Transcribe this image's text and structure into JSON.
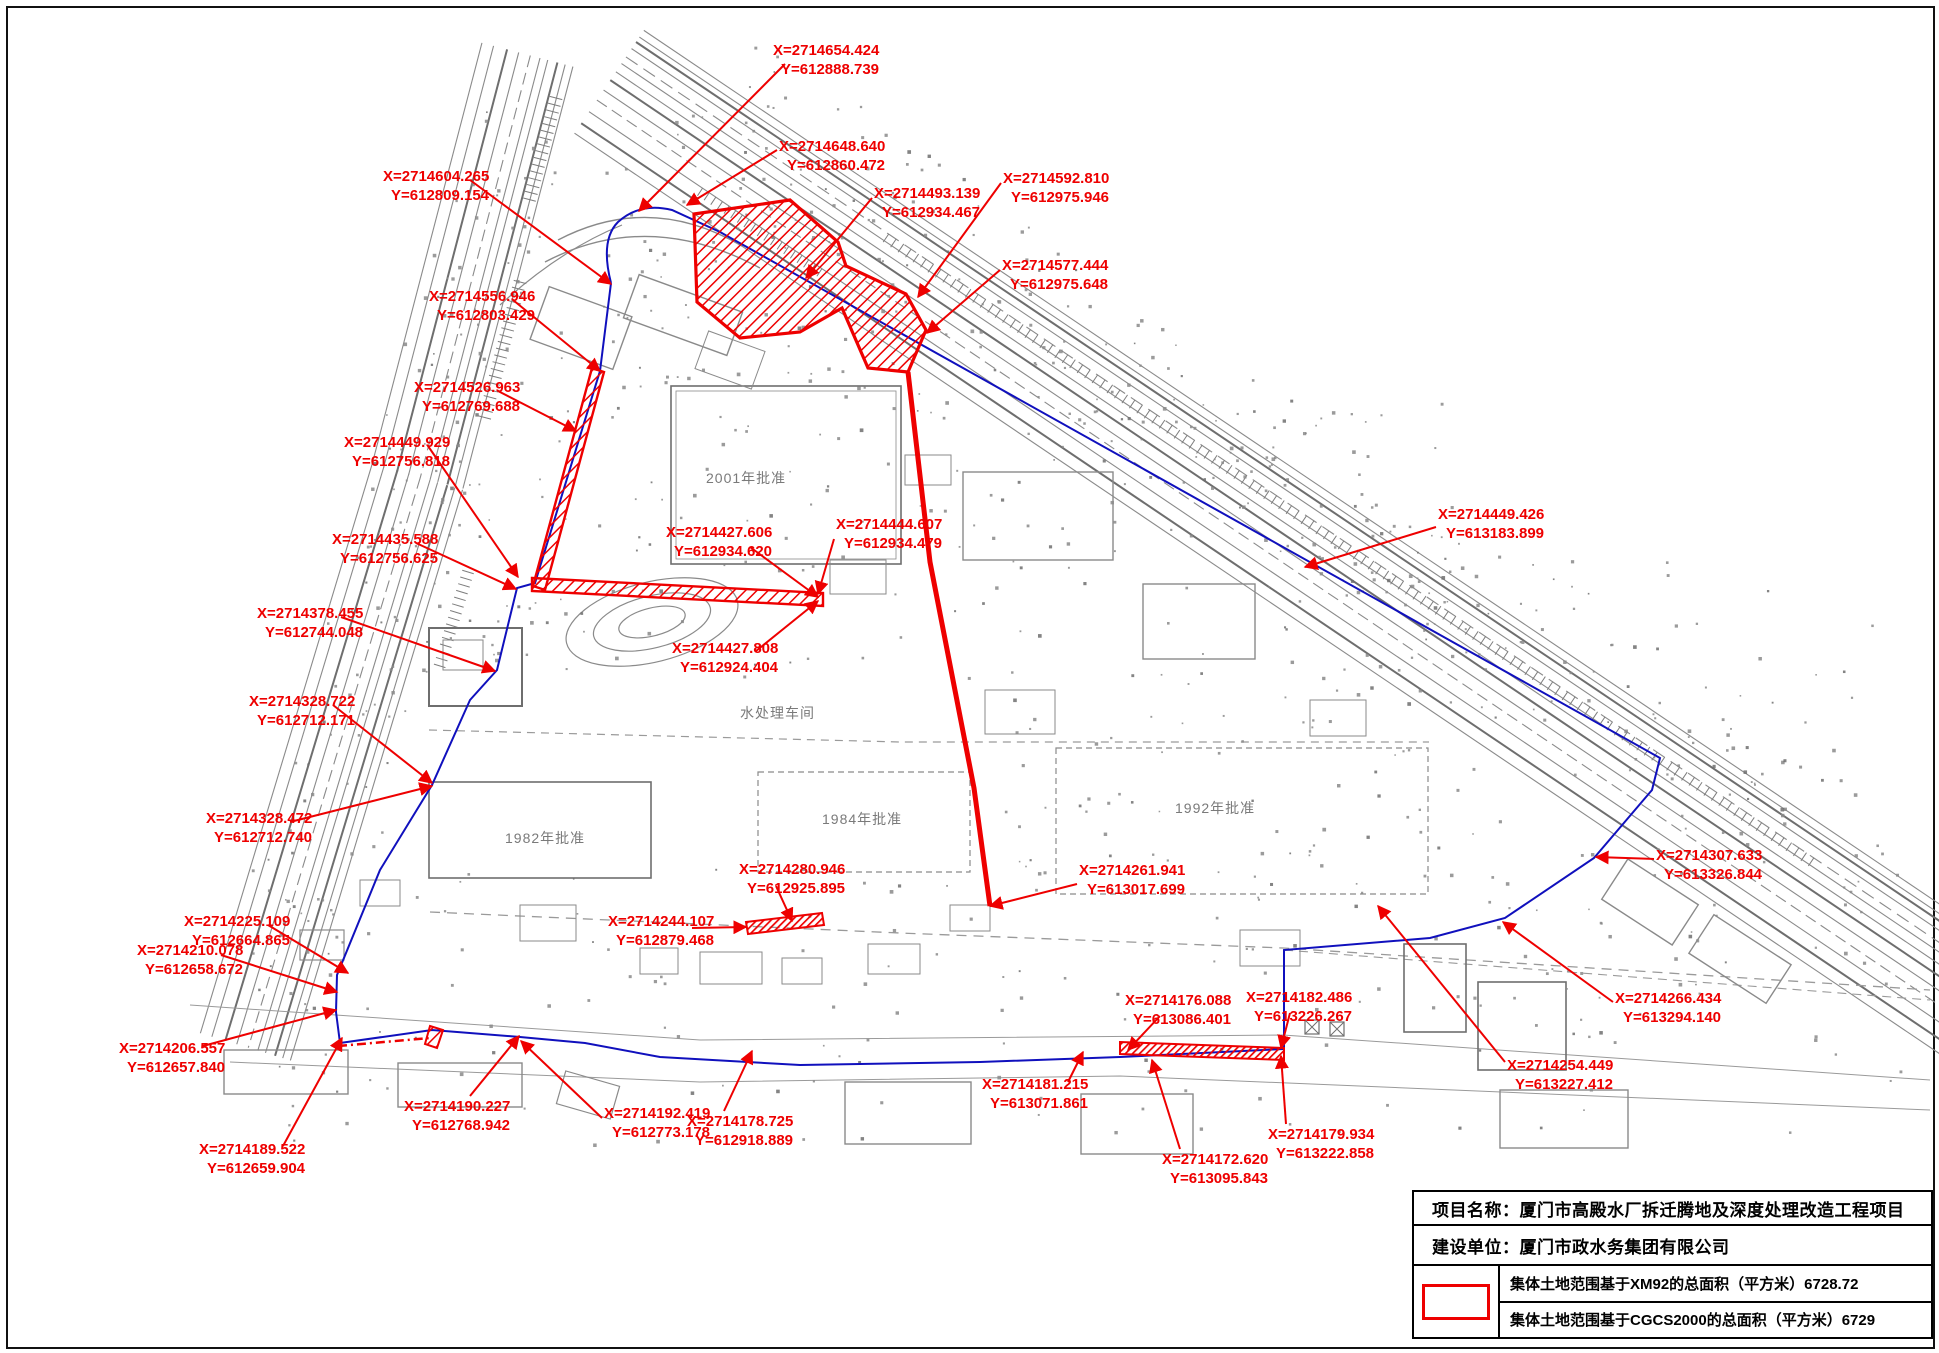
{
  "page": {
    "width": 1939,
    "height": 1353
  },
  "colors": {
    "annotation_red": "#ee0000",
    "boundary_blue": "#1010bd",
    "linework_gray": "#8a8a8a",
    "linework_dark": "#6e6e6e"
  },
  "map": {
    "coordinate_labels": [
      {
        "x": "X=2714654.424",
        "y": "Y=612888.739",
        "tx": 773,
        "ty": 42,
        "lead": [
          [
            785,
            64
          ],
          [
            639,
            211
          ]
        ]
      },
      {
        "x": "X=2714648.640",
        "y": "Y=612860.472",
        "tx": 779,
        "ty": 138,
        "lead": [
          [
            777,
            150
          ],
          [
            687,
            205
          ]
        ]
      },
      {
        "x": "X=2714604.265",
        "y": "Y=612809.154",
        "tx": 383,
        "ty": 168,
        "lead": [
          [
            470,
            180
          ],
          [
            611,
            284
          ]
        ]
      },
      {
        "x": "X=2714493.139",
        "y": "Y=612934.467",
        "tx": 874,
        "ty": 185,
        "lead": [
          [
            872,
            198
          ],
          [
            806,
            278
          ]
        ]
      },
      {
        "x": "X=2714592.810",
        "y": "Y=612975.946",
        "tx": 1003,
        "ty": 170,
        "lead": [
          [
            1001,
            183
          ],
          [
            918,
            297
          ]
        ]
      },
      {
        "x": "X=2714577.444",
        "y": "Y=612975.648",
        "tx": 1002,
        "ty": 257,
        "lead": [
          [
            1000,
            270
          ],
          [
            927,
            333
          ]
        ]
      },
      {
        "x": "X=2714556.946",
        "y": "Y=612803.429",
        "tx": 429,
        "ty": 288,
        "lead": [
          [
            513,
            300
          ],
          [
            600,
            371
          ]
        ]
      },
      {
        "x": "X=2714526.963",
        "y": "Y=612769.688",
        "tx": 414,
        "ty": 379,
        "lead": [
          [
            498,
            391
          ],
          [
            576,
            431
          ]
        ]
      },
      {
        "x": "X=2714449.929",
        "y": "Y=612756.818",
        "tx": 344,
        "ty": 434,
        "lead": [
          [
            428,
            446
          ],
          [
            518,
            577
          ]
        ]
      },
      {
        "x": "X=2714435.588",
        "y": "Y=612756.625",
        "tx": 332,
        "ty": 531,
        "lead": [
          [
            416,
            543
          ],
          [
            516,
            589
          ]
        ]
      },
      {
        "x": "X=2714378.455",
        "y": "Y=612744.048",
        "tx": 257,
        "ty": 605,
        "lead": [
          [
            341,
            617
          ],
          [
            495,
            671
          ]
        ]
      },
      {
        "x": "X=2714328.722",
        "y": "Y=612712.171",
        "tx": 249,
        "ty": 693,
        "lead": [
          [
            333,
            705
          ],
          [
            432,
            783
          ]
        ]
      },
      {
        "x": "X=2714328.472",
        "y": "Y=612712.740",
        "tx": 206,
        "ty": 810,
        "lead": [
          [
            290,
            822
          ],
          [
            432,
            786
          ]
        ]
      },
      {
        "x": "X=2714225.109",
        "y": "Y=612664.865",
        "tx": 184,
        "ty": 913,
        "lead": [
          [
            268,
            925
          ],
          [
            348,
            973
          ]
        ]
      },
      {
        "x": "X=2714210.078",
        "y": "Y=612658.672",
        "tx": 137,
        "ty": 942,
        "lead": [
          [
            221,
            955
          ],
          [
            337,
            992
          ]
        ]
      },
      {
        "x": "X=2714206.557",
        "y": "Y=612657.840",
        "tx": 119,
        "ty": 1040,
        "lead": [
          [
            203,
            1046
          ],
          [
            336,
            1010
          ]
        ]
      },
      {
        "x": "X=2714189.522",
        "y": "Y=612659.904",
        "tx": 199,
        "ty": 1141,
        "lead": [
          [
            283,
            1146
          ],
          [
            342,
            1038
          ]
        ]
      },
      {
        "x": "X=2714190.227",
        "y": "Y=612768.942",
        "tx": 404,
        "ty": 1098,
        "lead": [
          [
            470,
            1096
          ],
          [
            519,
            1036
          ]
        ]
      },
      {
        "x": "X=2714192.419",
        "y": "Y=612773.178",
        "tx": 604,
        "ty": 1105,
        "lead": [
          [
            602,
            1118
          ],
          [
            521,
            1041
          ]
        ]
      },
      {
        "x": "X=2714178.725",
        "y": "Y=612918.889",
        "tx": 687,
        "ty": 1113,
        "lead": [
          [
            724,
            1111
          ],
          [
            752,
            1051
          ]
        ]
      },
      {
        "x": "X=2714280.946",
        "y": "Y=612925.895",
        "tx": 739,
        "ty": 861,
        "lead": [
          [
            776,
            886
          ],
          [
            792,
            921
          ]
        ]
      },
      {
        "x": "X=2714244.107",
        "y": "Y=612879.468",
        "tx": 608,
        "ty": 913,
        "lead": [
          [
            692,
            928
          ],
          [
            746,
            927
          ]
        ]
      },
      {
        "x": "X=2714261.941",
        "y": "Y=613017.699",
        "tx": 1079,
        "ty": 862,
        "lead": [
          [
            1077,
            884
          ],
          [
            990,
            906
          ]
        ]
      },
      {
        "x": "X=2714427.606",
        "y": "Y=612934.620",
        "tx": 666,
        "ty": 524,
        "lead": [
          [
            750,
            547
          ],
          [
            818,
            597
          ]
        ]
      },
      {
        "x": "X=2714444.607",
        "y": "Y=612934.479",
        "tx": 836,
        "ty": 516,
        "lead": [
          [
            834,
            539
          ],
          [
            818,
            594
          ]
        ]
      },
      {
        "x": "X=2714427.808",
        "y": "Y=612924.404",
        "tx": 672,
        "ty": 640,
        "lead": [
          [
            756,
            651
          ],
          [
            818,
            601
          ]
        ]
      },
      {
        "x": "X=2714449.426",
        "y": "Y=613183.899",
        "tx": 1438,
        "ty": 506,
        "lead": [
          [
            1436,
            527
          ],
          [
            1305,
            567
          ]
        ]
      },
      {
        "x": "X=2714307.633",
        "y": "Y=613326.844",
        "tx": 1656,
        "ty": 847,
        "lead": [
          [
            1654,
            859
          ],
          [
            1596,
            857
          ]
        ]
      },
      {
        "x": "X=2714266.434",
        "y": "Y=613294.140",
        "tx": 1615,
        "ty": 990,
        "lead": [
          [
            1613,
            1002
          ],
          [
            1503,
            922
          ]
        ]
      },
      {
        "x": "X=2714254.449",
        "y": "Y=613227.412",
        "tx": 1507,
        "ty": 1057,
        "lead": [
          [
            1505,
            1062
          ],
          [
            1378,
            906
          ]
        ]
      },
      {
        "x": "X=2714182.486",
        "y": "Y=613226.267",
        "tx": 1246,
        "ty": 989,
        "lead": [
          [
            1290,
            1013
          ],
          [
            1281,
            1048
          ]
        ]
      },
      {
        "x": "X=2714176.088",
        "y": "Y=613086.401",
        "tx": 1125,
        "ty": 992,
        "lead": [
          [
            1160,
            1016
          ],
          [
            1128,
            1050
          ]
        ]
      },
      {
        "x": "X=2714181.215",
        "y": "Y=613071.861",
        "tx": 982,
        "ty": 1076,
        "lead": [
          [
            1068,
            1082
          ],
          [
            1083,
            1052
          ]
        ]
      },
      {
        "x": "X=2714172.620",
        "y": "Y=613095.843",
        "tx": 1162,
        "ty": 1151,
        "lead": [
          [
            1180,
            1149
          ],
          [
            1152,
            1060
          ]
        ]
      },
      {
        "x": "X=2714179.934",
        "y": "Y=613222.858",
        "tx": 1268,
        "ty": 1126,
        "lead": [
          [
            1286,
            1124
          ],
          [
            1281,
            1056
          ]
        ]
      }
    ],
    "area_labels": [
      {
        "text": "2001年批准",
        "x": 706,
        "y": 483
      },
      {
        "text": "1982年批准",
        "x": 505,
        "y": 843
      },
      {
        "text": "1984年批准",
        "x": 822,
        "y": 824
      },
      {
        "text": "1992年批准",
        "x": 1175,
        "y": 813
      },
      {
        "text": "水处理车间",
        "x": 740,
        "y": 718
      }
    ]
  },
  "title_block": {
    "rows": [
      {
        "label": "项目名称：",
        "value": "厦门市高殿水厂拆迁腾地及深度处理改造工程项目"
      },
      {
        "label": "建设单位：",
        "value": "厦门市政水务集团有限公司"
      }
    ],
    "legend_swatch_color": "#ee0000",
    "area_rows": [
      "集体土地范围基于XM92的总面积（平方米）6728.72",
      "集体土地范围基于CGCS2000的总面积（平方米）6729"
    ]
  }
}
